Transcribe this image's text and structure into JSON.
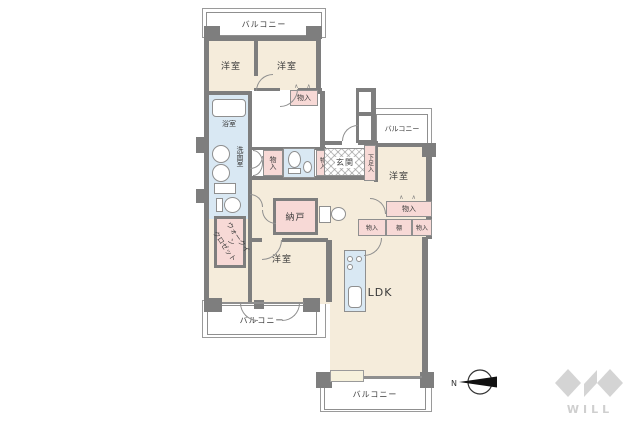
{
  "labels": {
    "balcony": "バルコニー",
    "western_room": "洋室",
    "bathroom": "浴室",
    "washroom": "洗面室",
    "walk_in_closet_line1": "ウォークイン",
    "walk_in_closet_line2": "クロゼット",
    "entrance": "玄関",
    "shoe_cabinet": "下足入",
    "storage_room": "納戸",
    "closet": "物入",
    "shelf": "棚",
    "ldk": "LDK"
  },
  "compass": {
    "north_label": "N"
  },
  "logo": {
    "text": "WILL"
  },
  "symbols": {
    "folding_door_mark": "∧ ∧"
  },
  "colors": {
    "wall": "#7e7e7e",
    "floor": "#f5ecdb",
    "wet_area": "#d9e8f3",
    "storage": "#f7d9d6",
    "outline": "#8f8f8f",
    "logo_gray": "#d4d4d4"
  }
}
